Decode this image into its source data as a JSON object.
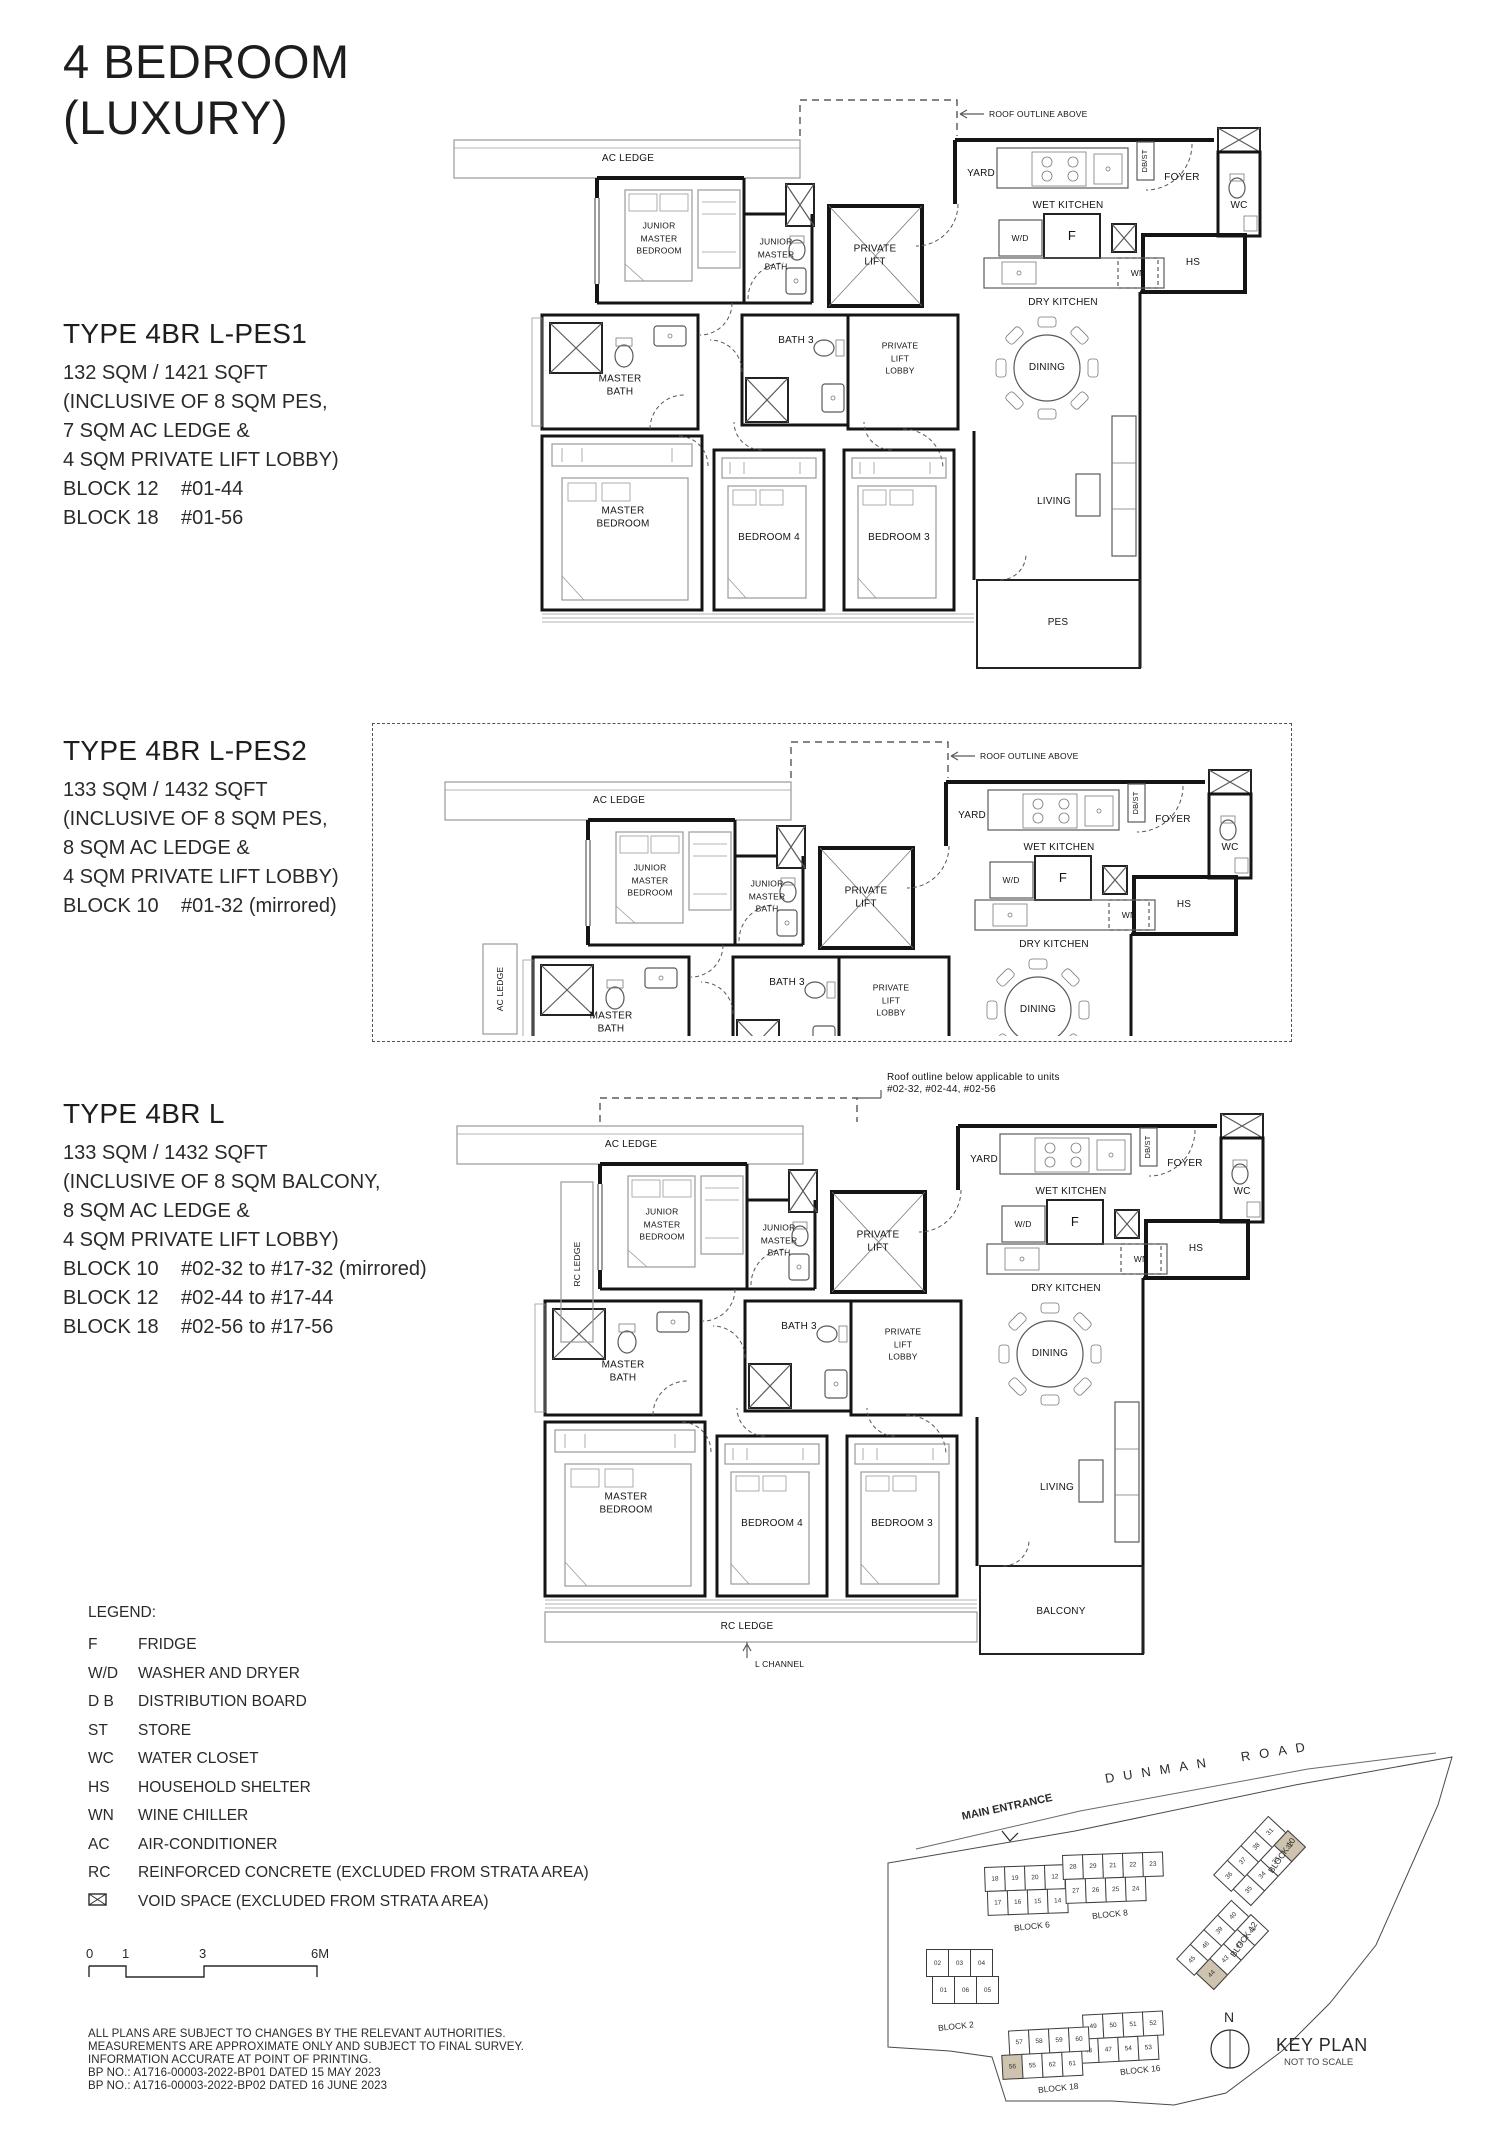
{
  "title": {
    "text": "4 BEDROOM\n(LUXURY)"
  },
  "types": [
    {
      "title": "TYPE 4BR L-PES1",
      "area": "132 SQM / 1421 SQFT",
      "inclusive": "(INCLUSIVE OF 8 SQM PES,\n7 SQM AC LEDGE &\n4 SQM PRIVATE LIFT LOBBY)",
      "blocks": [
        {
          "block": "BLOCK 12",
          "units": "#01-44"
        },
        {
          "block": "BLOCK 18",
          "units": "#01-56"
        }
      ]
    },
    {
      "title": "TYPE 4BR L-PES2",
      "area": "133 SQM / 1432 SQFT",
      "inclusive": "(INCLUSIVE OF 8 SQM PES,\n8 SQM AC LEDGE &\n4 SQM PRIVATE LIFT LOBBY)",
      "blocks": [
        {
          "block": "BLOCK 10",
          "units": "#01-32 (mirrored)"
        }
      ]
    },
    {
      "title": "TYPE 4BR L",
      "area": "133 SQM / 1432 SQFT",
      "inclusive": "(INCLUSIVE OF 8 SQM BALCONY,\n8 SQM AC LEDGE &\n4 SQM PRIVATE LIFT LOBBY)",
      "blocks": [
        {
          "block": "BLOCK 10",
          "units": "#02-32 to #17-32 (mirrored)"
        },
        {
          "block": "BLOCK 12",
          "units": "#02-44 to #17-44"
        },
        {
          "block": "BLOCK 18",
          "units": "#02-56 to #17-56"
        }
      ]
    }
  ],
  "rooms": {
    "ac_ledge": "AC LEDGE",
    "rc_ledge": "RC LEDGE",
    "junior_master_bedroom": "JUNIOR\nMASTER\nBEDROOM",
    "junior_master_bath": "JUNIOR\nMASTER\nBATH",
    "private_lift": "PRIVATE\nLIFT",
    "private_lift_lobby": "PRIVATE\nLIFT\nLOBBY",
    "bath_3": "BATH 3",
    "master_bath": "MASTER\nBATH",
    "master_bedroom": "MASTER\nBEDROOM",
    "bedroom_4": "BEDROOM 4",
    "bedroom_3": "BEDROOM 3",
    "living": "LIVING",
    "dining": "DINING",
    "dry_kitchen": "DRY KITCHEN",
    "wet_kitchen": "WET  KITCHEN",
    "yard": "YARD",
    "foyer": "FOYER",
    "wc": "WC",
    "hs": "HS",
    "wd": "W/D",
    "f": "F",
    "wn": "WN",
    "db_st": "DB/ST",
    "pes": "PES",
    "balcony": "BALCONY",
    "l_channel": "L CHANNEL",
    "roof_outline_above": "ROOF OUTLINE ABOVE",
    "roof_outline_below": "Roof outline below applicable to units\n#02-32, #02-44, #02-56"
  },
  "legend": {
    "heading": "LEGEND:",
    "items": [
      {
        "key": "F",
        "label": "FRIDGE"
      },
      {
        "key": "W/D",
        "label": "WASHER AND DRYER"
      },
      {
        "key": "D B",
        "label": "DISTRIBUTION BOARD"
      },
      {
        "key": "ST",
        "label": "STORE"
      },
      {
        "key": "WC",
        "label": "WATER CLOSET"
      },
      {
        "key": "HS",
        "label": "HOUSEHOLD SHELTER"
      },
      {
        "key": "WN",
        "label": "WINE CHILLER"
      },
      {
        "key": "AC",
        "label": "AIR-CONDITIONER"
      },
      {
        "key": "RC",
        "label": "REINFORCED CONCRETE (EXCLUDED FROM STRATA AREA)"
      }
    ],
    "void_item": {
      "label": "VOID SPACE (EXCLUDED FROM STRATA AREA)"
    }
  },
  "scale_bar": {
    "ticks": [
      "0",
      "1",
      "3",
      "6M"
    ]
  },
  "disclaimer": "ALL PLANS ARE SUBJECT TO CHANGES BY THE RELEVANT AUTHORITIES.\nMEASUREMENTS ARE APPROXIMATE ONLY AND SUBJECT TO FINAL SURVEY.\nINFORMATION ACCURATE AT POINT OF PRINTING.\nBP NO.: A1716-00003-2022-BP01 DATED 15 MAY 2023\nBP NO.: A1716-00003-2022-BP02 DATED 16 JUNE 2023",
  "key_plan": {
    "heading": "KEY PLAN",
    "subheading": "NOT TO SCALE",
    "north": "N",
    "road": "DUNMAN ROAD",
    "main_entrance": "MAIN ENTRANCE",
    "highlight_color": "#cdc3ae",
    "highlighted_units": [
      "32",
      "44",
      "56"
    ],
    "blocks": [
      {
        "name": "BLOCK 2",
        "rows": [
          [
            "02",
            "03",
            "04"
          ],
          [
            "01",
            "06",
            "05"
          ]
        ]
      },
      {
        "name": "BLOCK 6",
        "rows": [
          [
            "18",
            "19",
            "20",
            "12",
            "13"
          ],
          [
            "17",
            "16",
            "15",
            "14"
          ]
        ]
      },
      {
        "name": "BLOCK 8",
        "rows": [
          [
            "28",
            "29",
            "21",
            "22",
            "23"
          ],
          [
            "27",
            "26",
            "25",
            "24"
          ]
        ]
      },
      {
        "name": "BLOCK 10",
        "rows": [
          [
            "36",
            "37",
            "38",
            "31"
          ],
          [
            "35",
            "34",
            "33",
            "32"
          ]
        ],
        "highlight": "32"
      },
      {
        "name": "BLOCK 12",
        "rows": [
          [
            "45",
            "46",
            "39",
            "40"
          ],
          [
            "44",
            "43",
            "42",
            "41"
          ]
        ],
        "highlight": "44"
      },
      {
        "name": "BLOCK 16",
        "rows": [
          [
            "49",
            "50",
            "51",
            "52"
          ],
          [
            "48",
            "47",
            "54",
            "53"
          ]
        ]
      },
      {
        "name": "BLOCK 18",
        "rows": [
          [
            "57",
            "58",
            "59",
            "60"
          ],
          [
            "56",
            "55",
            "62",
            "61"
          ]
        ],
        "highlight": "56"
      }
    ]
  }
}
